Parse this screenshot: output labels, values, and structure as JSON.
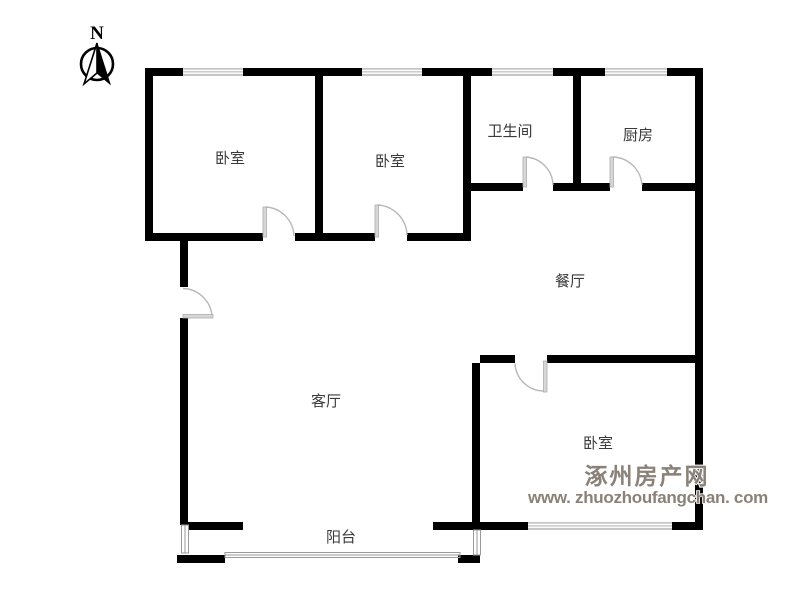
{
  "compass": {
    "label": "N"
  },
  "rooms": [
    {
      "id": "bedroom-top-left",
      "label": "卧室"
    },
    {
      "id": "bedroom-top-middle",
      "label": "卧室"
    },
    {
      "id": "bathroom",
      "label": "卫生间"
    },
    {
      "id": "kitchen",
      "label": "厨房"
    },
    {
      "id": "dining-room",
      "label": "餐厅"
    },
    {
      "id": "living-room",
      "label": "客厅"
    },
    {
      "id": "bedroom-bottom-right",
      "label": "卧室"
    },
    {
      "id": "balcony",
      "label": "阳台"
    }
  ],
  "watermark": {
    "site_name": "涿州房产网",
    "site_url": "www. zhuozhoufangchan. com",
    "color": "#8a8178"
  },
  "colors": {
    "wall": "#000000",
    "window": "#c6c6c6",
    "door_arc": "#b8b8b8",
    "label": "#3a3a3a"
  }
}
